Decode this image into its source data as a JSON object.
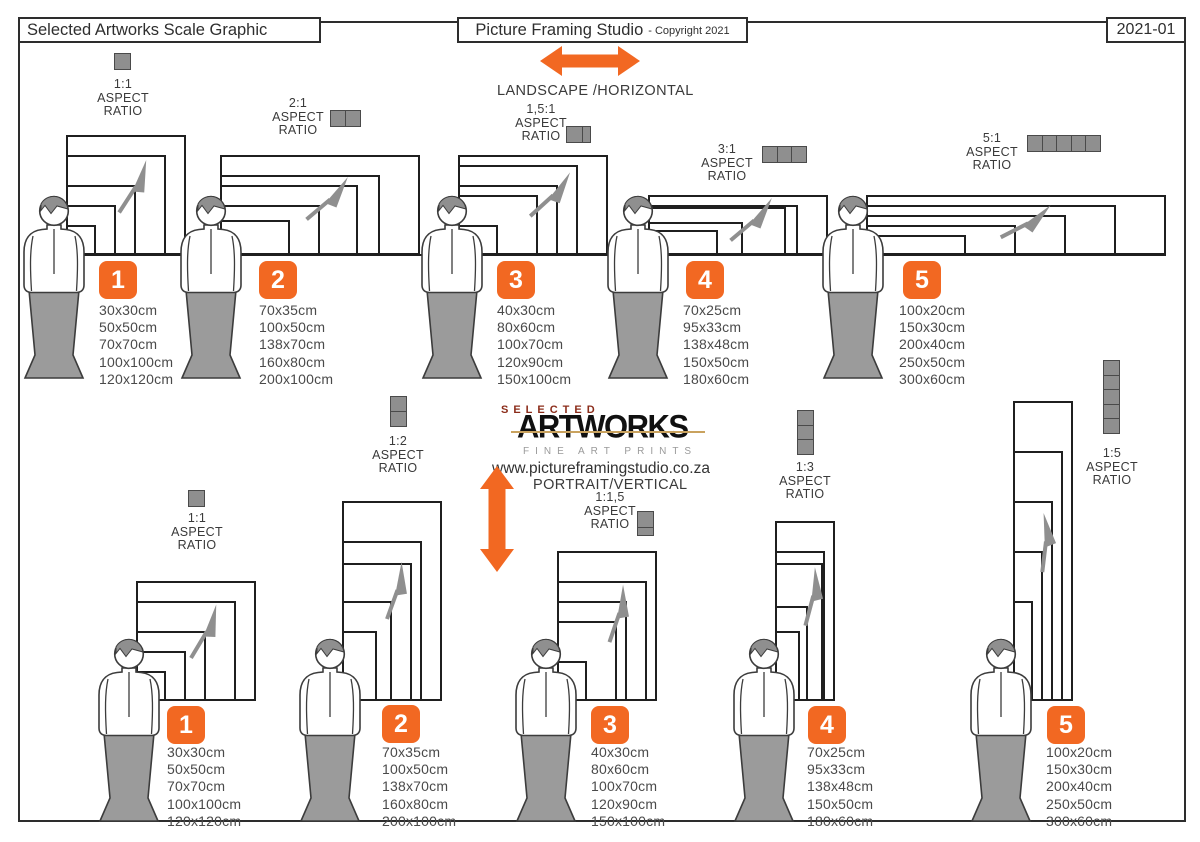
{
  "header": {
    "left_title": "Selected Artworks Scale Graphic",
    "studio_title": "Picture Framing Studio",
    "copyright": "- Copyright 2021",
    "doc_number": "2021-01"
  },
  "labels": {
    "aspect": "ASPECT",
    "ratio": "RATIO"
  },
  "logo": {
    "selected": "SELECTED",
    "artworks": "ARTWORKS",
    "tagline": "FINE ART PRINTS",
    "website": "www.pictureframingstudio.co.za"
  },
  "colors": {
    "accent_orange": "#F26822",
    "shape_gray": "#8F8F8F",
    "logo_red": "#8B2C1A",
    "logo_gold": "#C9A25E",
    "line_black": "#1F1F1F"
  },
  "landscape": {
    "heading": "LANDSCAPE /HORIZONTAL",
    "groups": [
      {
        "number": "1",
        "ratio": "1:1",
        "units": 1,
        "sizes": [
          "30x30cm",
          "50x50cm",
          "70x70cm",
          "100x100cm",
          "120x120cm"
        ]
      },
      {
        "number": "2",
        "ratio": "2:1",
        "units": 2,
        "sizes": [
          "70x35cm",
          "100x50cm",
          "138x70cm",
          "160x80cm",
          "200x100cm"
        ]
      },
      {
        "number": "3",
        "ratio": "1,5:1",
        "units": 1.5,
        "sizes": [
          "40x30cm",
          "80x60cm",
          "100x70cm",
          "120x90cm",
          "150x100cm"
        ]
      },
      {
        "number": "4",
        "ratio": "3:1",
        "units": 3,
        "sizes": [
          "70x25cm",
          "95x33cm",
          "138x48cm",
          "150x50cm",
          "180x60cm"
        ]
      },
      {
        "number": "5",
        "ratio": "5:1",
        "units": 5,
        "sizes": [
          "100x20cm",
          "150x30cm",
          "200x40cm",
          "250x50cm",
          "300x60cm"
        ]
      }
    ]
  },
  "portrait": {
    "heading": "PORTRAIT/VERTICAL",
    "groups": [
      {
        "number": "1",
        "ratio": "1:1",
        "units": 1,
        "sizes": [
          "30x30cm",
          "50x50cm",
          "70x70cm",
          "100x100cm",
          "120x120cm"
        ]
      },
      {
        "number": "2",
        "ratio": "1:2",
        "units": 2,
        "sizes": [
          "70x35cm",
          "100x50cm",
          "138x70cm",
          "160x80cm",
          "200x100cm"
        ]
      },
      {
        "number": "3",
        "ratio": "1:1,5",
        "units": 1.5,
        "sizes": [
          "40x30cm",
          "80x60cm",
          "100x70cm",
          "120x90cm",
          "150x100cm"
        ]
      },
      {
        "number": "4",
        "ratio": "1:3",
        "units": 3,
        "sizes": [
          "70x25cm",
          "95x33cm",
          "138x48cm",
          "150x50cm",
          "180x60cm"
        ]
      },
      {
        "number": "5",
        "ratio": "1:5",
        "units": 5,
        "sizes": [
          "100x20cm",
          "150x30cm",
          "200x40cm",
          "250x50cm",
          "300x60cm"
        ]
      }
    ]
  }
}
